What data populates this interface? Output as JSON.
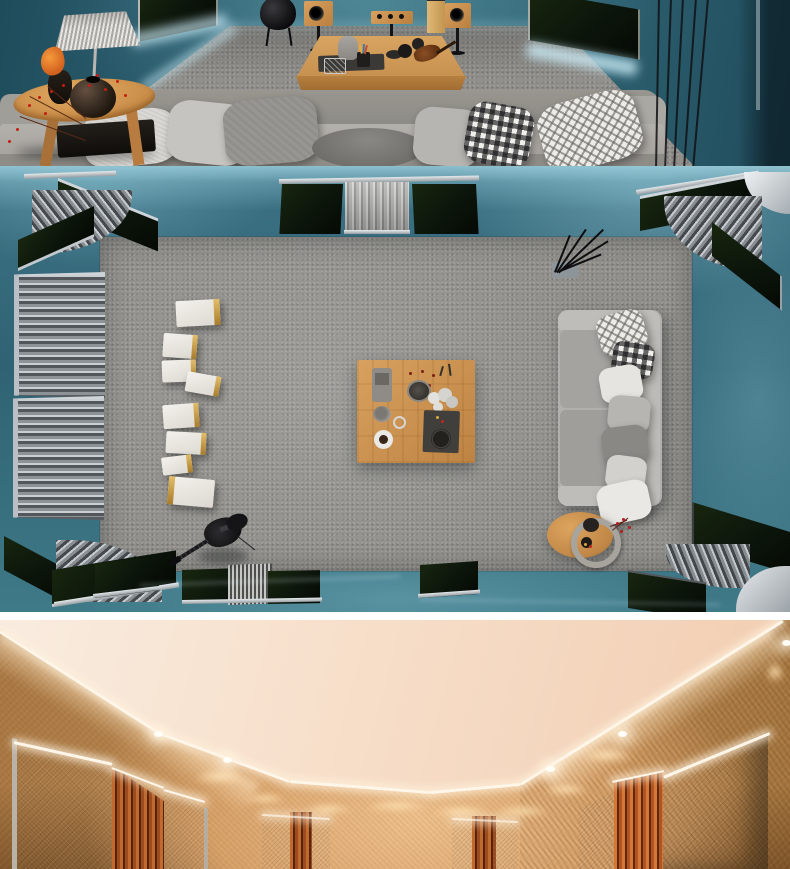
{
  "meta": {
    "description": "Collage of three 3D interior renders: a teal fabric-walled hi-fi living room at eye level with LED backlit acoustic panels, a top-down plan view of the same listening room with corner bass traps, diffusers, speakers, sofa and coffee table, and a warm beige home-theater wall with LED cove lighting, fabric absorbers and wood-slat diffusers.",
    "visible_text": "none"
  },
  "palette": {
    "teal-wall-dark": "#1e4856",
    "teal-wall": "#2f6272",
    "teal-floor": "#3b7183",
    "teal-floor-light": "#7fb2c1",
    "led-cool": "#cdeef9",
    "panel-green": "#0c150b",
    "frame-silver": "#c3c9cd",
    "carpet": "#908f8b",
    "sofa": "#a7a5a1",
    "pillow-white": "#e8e6e2",
    "pillow-gray": "#b4b2ae",
    "wood": "#c89050",
    "wood-dark": "#9f6c33",
    "speaker-white": "#e9e7e2",
    "gold": "#c29b45",
    "black": "#141414",
    "ceiling": "#f7e6d6",
    "ochre": "#bb8a51",
    "ochre-dark": "#7d5427",
    "sand": "#ecc08a",
    "taupe-panel": "#8b7d6c",
    "slat-orange": "#b05f2b",
    "led-warm": "#fff6ea"
  },
  "sections": [
    {
      "name": "living-room-eye-level",
      "objects": [
        "teal-fabric-wall",
        "acoustic-panel-backlit",
        "led-cove-glow",
        "hanging-egg-chair",
        "bookshelf-speakers",
        "center-channel-speaker",
        "tower-speaker",
        "speaker-stands",
        "coffee-table",
        "smart-speaker",
        "serving-tray",
        "violin-decor",
        "sectional-sofa",
        "throw-pillows",
        "gingham-pillow",
        "diamond-pattern-pillow",
        "wooden-side-table",
        "woven-table-lamp",
        "dark-vase",
        "berry-branches",
        "orange-flower",
        "string-curtain"
      ]
    },
    {
      "name": "listening-room-top-down-plan",
      "objects": [
        "teal-velvet-floor",
        "gray-carpet",
        "corner-bass-traps",
        "curved-ribbed-diffusers",
        "wall-absorber-panels",
        "curtain-diffuser",
        "slat-diffuser-panels",
        "speaker-cabinets",
        "square-coffee-table",
        "tea-set",
        "coffee-cup",
        "slate-tray",
        "flower-bunch",
        "sofa-plan-view",
        "seat-cushions",
        "throw-pillows",
        "oval-side-table",
        "electric-guitar",
        "stick-sculpture"
      ]
    },
    {
      "name": "home-theater-beige",
      "objects": [
        "cream-ceiling",
        "led-cove-strip",
        "recessed-downlights",
        "ochre-fabric-walls",
        "scalloped-wall-wash",
        "fabric-absorber-panels",
        "wood-slat-diffusers",
        "panel-edge-lighting"
      ]
    }
  ]
}
